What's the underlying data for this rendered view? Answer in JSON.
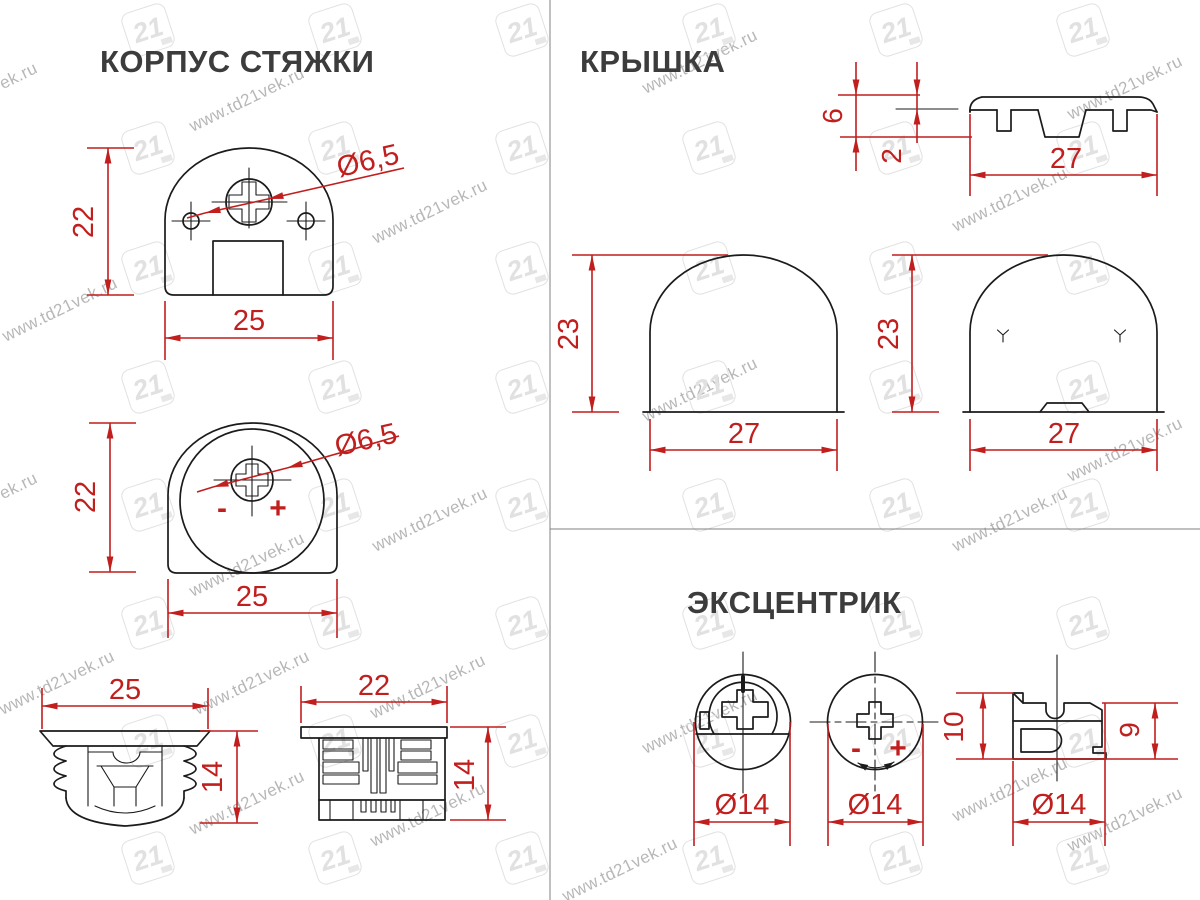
{
  "watermark": {
    "text": "www.td21vek.ru",
    "logo": "21"
  },
  "titles": {
    "body": "КОРПУС СТЯЖКИ",
    "cap": "КРЫШКА",
    "cam": "ЭКСЦЕНТРИК"
  },
  "body_front": {
    "height": "22",
    "width": "25",
    "hole": "Ø6,5"
  },
  "body_back": {
    "height": "22",
    "width": "25",
    "hole": "Ø6,5",
    "minus": "-",
    "plus": "+"
  },
  "body_side_a": {
    "width": "25",
    "height": "14"
  },
  "body_side_b": {
    "width": "22",
    "height": "14"
  },
  "cap_profile": {
    "height": "6",
    "thickness": "2",
    "width": "27"
  },
  "cap_front": {
    "height": "23",
    "width": "27"
  },
  "cap_back": {
    "height": "23",
    "width": "27"
  },
  "cam_front": {
    "diameter": "Ø14"
  },
  "cam_mark": {
    "diameter": "Ø14",
    "minus": "-",
    "plus": "+"
  },
  "cam_side": {
    "height_outer": "10",
    "height_inner": "9",
    "diameter": "Ø14"
  }
}
